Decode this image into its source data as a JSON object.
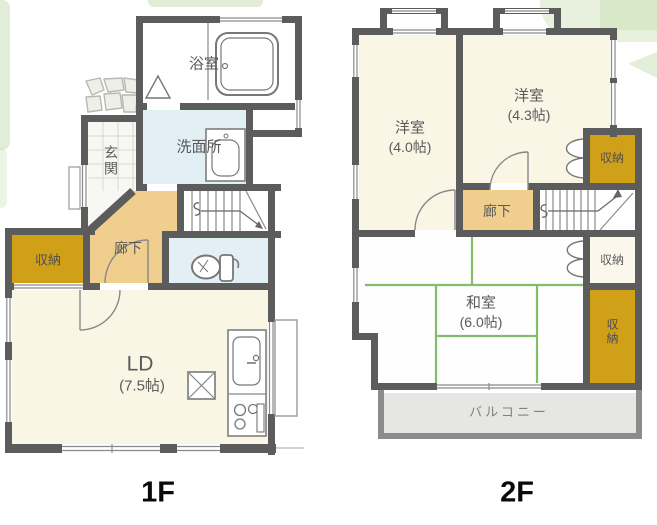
{
  "floor1": {
    "floor_label": "1F",
    "rooms": {
      "bathroom": "浴室",
      "washroom": "洗面所",
      "entrance": "玄関",
      "hallway": "廊下",
      "storage": "収納",
      "living_dining_name": "LD",
      "living_dining_size": "(7.5帖)"
    }
  },
  "floor2": {
    "floor_label": "2F",
    "rooms": {
      "western_room_left_name": "洋室",
      "western_room_left_size": "(4.0帖)",
      "western_room_right_name": "洋室",
      "western_room_right_size": "(4.3帖)",
      "hallway": "廊下",
      "storage_upper": "収納",
      "storage_middle": "収納",
      "storage_lower": "収納",
      "japanese_room_name": "和室",
      "japanese_room_size": "(6.0帖)",
      "balcony": "バルコニー"
    }
  },
  "colors": {
    "wall": "#5c5c5c",
    "room_cream": "#faf6e6",
    "hallway_tan": "#f0ce8e",
    "storage_gold": "#d0a019",
    "wet_area_blue": "#e2eff5",
    "tatami_line_green": "#82bd6a",
    "balcony_gray": "#e6e6e3",
    "background_leaf_green": "#c9dfb4"
  },
  "icons": {
    "bathtub-icon": "bathtub outline in bathroom",
    "washbasin-icon": "washbasin unit in washroom",
    "toilet-icon": "toilet bowl with tank",
    "kitchen-sink-icon": "kitchen sink with faucet",
    "stove-icon": "gas stove with burners",
    "dining-table-icon": "square table with X",
    "stairs-up-arrow-icon": "staircase direction arrow",
    "door-swing-icon": "door swing arc",
    "folding-door-icon": "closet folding doors",
    "window-icon": "double-line window in wall",
    "stepping-stones-icon": "entrance approach stones"
  }
}
